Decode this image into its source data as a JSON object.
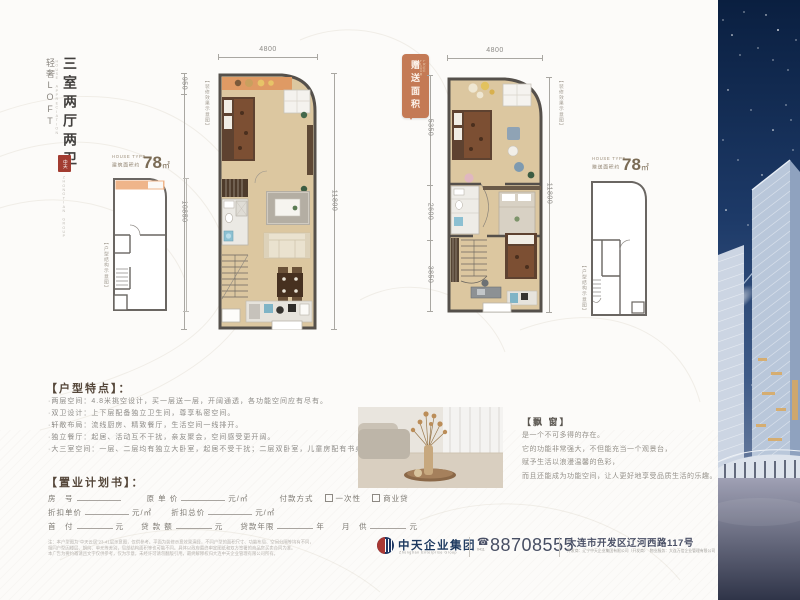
{
  "brand": {
    "series_vertical": "轻奢LOFT",
    "series_en": "HOUSE APPRECIATION",
    "headline_vertical": "三室两厅两卫",
    "seal_text": "中天",
    "seal_caption_en": "ZHONGTIAN GROUP"
  },
  "plan_a": {
    "dim_top": "4800",
    "dim_right": "11800",
    "dim_left_upper": "950",
    "dim_left_lower": "10850",
    "side_note": "【装修效果示意图】"
  },
  "plan_b": {
    "gift_tag": "赠送面积",
    "gift_tag_en": "FREE FLOOR",
    "dim_top": "4800",
    "dim_right": "11800",
    "dim_left_1": "5350",
    "dim_left_2": "2600",
    "dim_left_3": "3850",
    "side_note": "【装修效果示意图】"
  },
  "mini_a": {
    "type_label": "HOUSE TYPE",
    "area_label": "建筑面积约",
    "area_value": "78",
    "area_unit": "㎡",
    "side_note": "【户型结构示意图】"
  },
  "mini_b": {
    "type_label": "HOUSE TYPE",
    "area_label": "赠送面积约",
    "area_value": "78",
    "area_unit": "㎡",
    "side_note": "【户型结构示意图】"
  },
  "features": {
    "title": "【户型特点】：",
    "items": [
      "·两层空间：4.8米挑空设计，买一层送一层，开阔通透，各功能空间应有尽有。",
      "·双卫设计：上下层配备独立卫生间，尊享私密空间。",
      "·轩敞布局：流线厨房、精致餐厅，生活空间一线排开。",
      "·独立餐厅：起居、活动互不干扰，亲友聚会，空间感受更开阔。",
      "·大三室空间：一层、二层均有独立大卧室，起居不受干扰；二层双卧室，儿童房配有书桌设计，学习环境更舒适。"
    ]
  },
  "bay_window": {
    "title": "【飘 窗】",
    "lines": [
      "是一个不可多得的存在。",
      "它的功能非常强大，不但能充当一个观景台，",
      "赋予生活以浪漫温馨的色彩，",
      "而且还能成为功能空间，让人更好地享受品质生活的乐趣。"
    ]
  },
  "plan_book": {
    "title": "【置业计划书】：",
    "row1": {
      "f1": "房　号",
      "f2": "原 单 价",
      "f2_unit": "元/㎡",
      "pay_label": "付款方式",
      "pay_opt1": "一次性",
      "pay_opt2": "商业贷"
    },
    "row2": {
      "f1": "折扣单价",
      "f1_unit": "元/㎡",
      "f2": "折扣总价",
      "f2_unit": "元/㎡"
    },
    "row3": {
      "f1": "首　付",
      "f1_unit": "元",
      "f2": "贷 款 额",
      "f2_unit": "元",
      "f3": "贷款年限",
      "f3_unit": "年",
      "f4": "月　供",
      "f4_unit": "元"
    },
    "notes": [
      "注：本户型图为“中天云居”23-41层示意图，仅供参考。平面为装修示意效果演绎，不同户型的面积尺寸、功能布局、空间分隔等均有不同，",
      "相同户型因楼层、朝向、单元等差别，局部结构面积等也可能不同。具体以政府最终审定图纸和双方签署的商品房买卖合同为准。",
      "本广告为要约邀请且文字仅供参考，仅为示意，未经许可请勿翻版引用，最终解释权归大连中天企业管理有限公司所有。"
    ]
  },
  "footer": {
    "company": "中天企业集团",
    "company_en": "Zhongtian Enterprise Group",
    "phone_area": "0411",
    "phone": "88708555",
    "address": "大连市开发区辽河西路117号",
    "address_note": "开发商：辽宁中天企业集团有限公司（开发商）　物业服务：大连万信企业管理有限公司"
  }
}
